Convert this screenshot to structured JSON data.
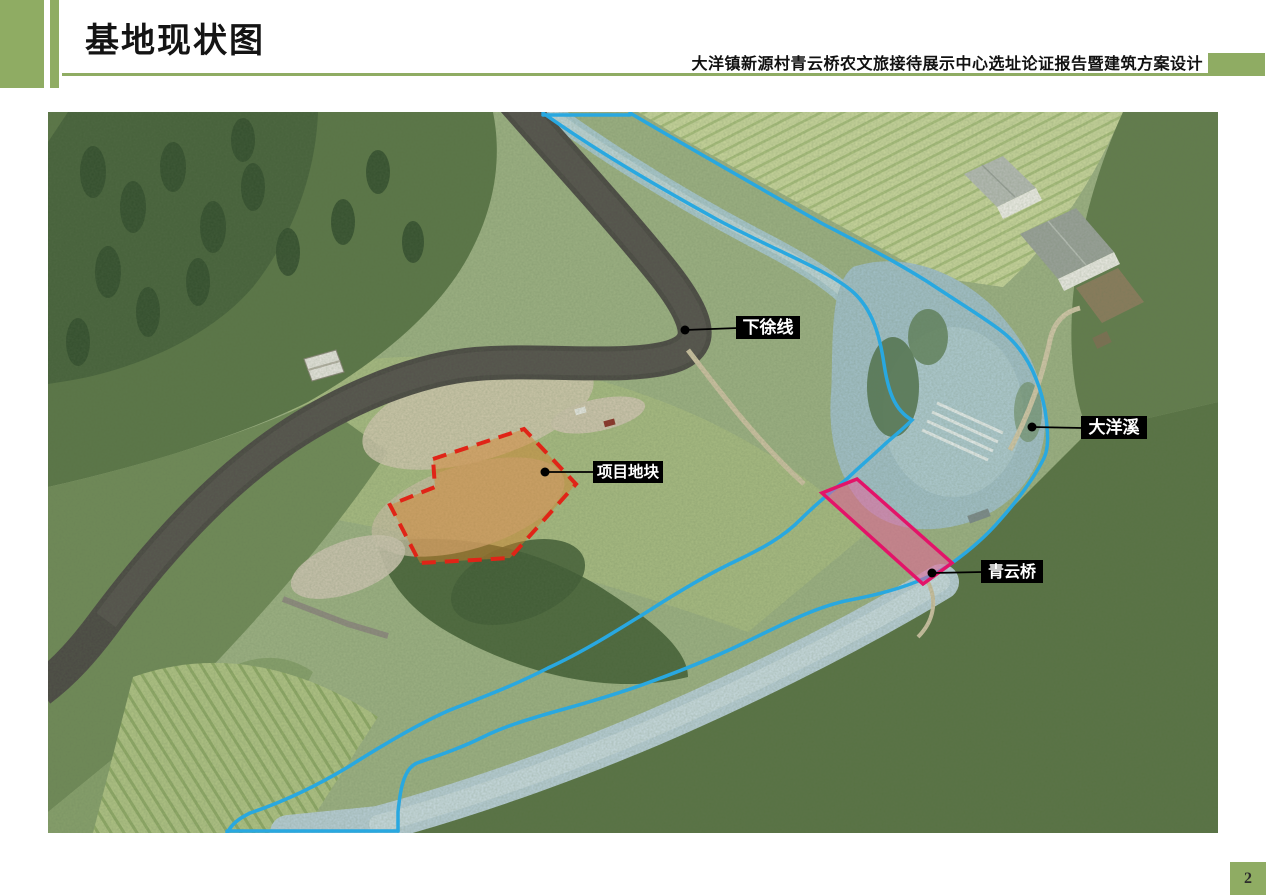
{
  "header": {
    "title": "基地现状图",
    "subtitle": "大洋镇新源村青云桥农文旅接待展示中心选址论证报告暨建筑方案设计"
  },
  "map": {
    "description": "航拍基地现状图（aerial site-status photo with annotations）",
    "labels": [
      {
        "id": "xiaxu-road",
        "text": "下徐线"
      },
      {
        "id": "dayang-creek",
        "text": "大洋溪"
      },
      {
        "id": "project-parcel",
        "text": "项目地块"
      },
      {
        "id": "qingyun-bridge",
        "text": "青云桥"
      }
    ]
  },
  "footer": {
    "page_number": "2"
  },
  "colors": {
    "accent_green": "#8fac63",
    "annotation_blue": "#29a8e0",
    "site_outline_red": "#e02417",
    "site_fill_orange": "#d67e26",
    "bridge_pink": "#e31369",
    "label_bg": "#000000",
    "label_text": "#ffffff"
  }
}
